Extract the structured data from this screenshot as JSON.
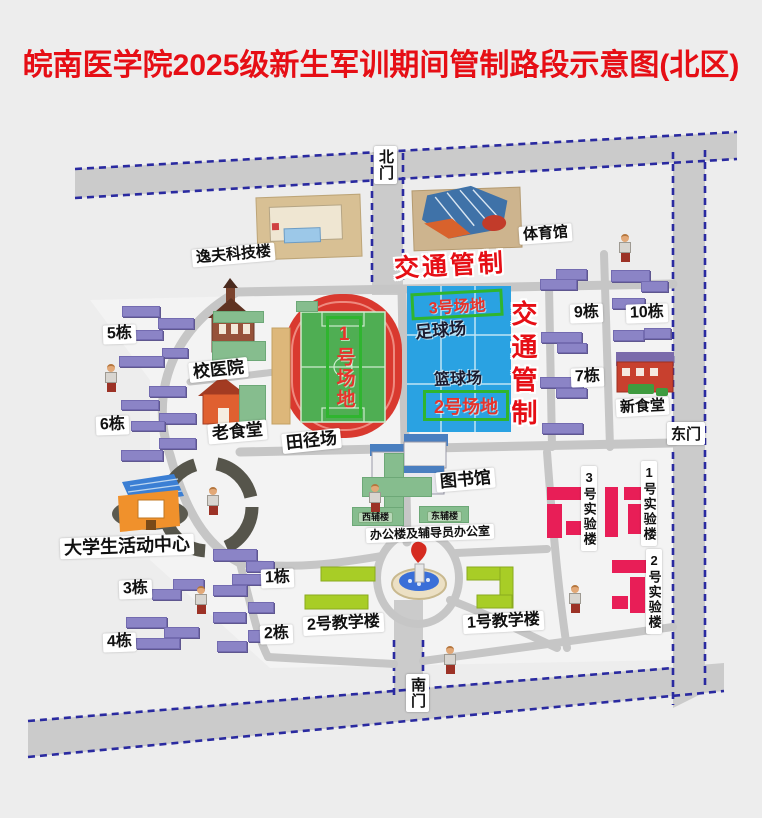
{
  "title": "皖南医学院2025级新生军训期间管制路段示意图(北区)",
  "traffic_control": {
    "horizontal": "交通管制",
    "vertical": "交通管制"
  },
  "gates": {
    "north": "北门",
    "east": "东门",
    "south": "南门"
  },
  "fields": {
    "field1": "1号场地",
    "field2": "2号场地",
    "field3": "3号场地",
    "football": "足球场",
    "basketball": "篮球场"
  },
  "labels": [
    {
      "name": "yifu-science-building",
      "text": "逸夫科技楼",
      "x": 192,
      "y": 246,
      "fs": 15,
      "rot": -5
    },
    {
      "name": "gymnasium",
      "text": "体育馆",
      "x": 519,
      "y": 225,
      "fs": 15,
      "rot": -4
    },
    {
      "name": "school-hospital",
      "text": "校医院",
      "x": 189,
      "y": 360,
      "fs": 17,
      "rot": -6
    },
    {
      "name": "old-canteen",
      "text": "老食堂",
      "x": 208,
      "y": 422,
      "fs": 17,
      "rot": -5
    },
    {
      "name": "athletic-track",
      "text": "田径场",
      "x": 282,
      "y": 431,
      "fs": 17,
      "rot": -6
    },
    {
      "name": "library",
      "text": "图书馆",
      "x": 436,
      "y": 470,
      "fs": 17,
      "rot": -5
    },
    {
      "name": "new-canteen",
      "text": "新食堂",
      "x": 616,
      "y": 398,
      "fs": 15,
      "rot": -3
    },
    {
      "name": "student-activity-center",
      "text": "大学生活动中心",
      "x": 60,
      "y": 536,
      "fs": 18,
      "rot": -2
    },
    {
      "name": "office-counselor-building",
      "text": "办公楼及辅导员办公室",
      "x": 366,
      "y": 526,
      "fs": 12,
      "rot": -2
    },
    {
      "name": "teaching-building-2",
      "text": "2号教学楼",
      "x": 303,
      "y": 615,
      "fs": 16,
      "rot": -3
    },
    {
      "name": "teaching-building-1",
      "text": "1号教学楼",
      "x": 463,
      "y": 613,
      "fs": 16,
      "rot": -3
    },
    {
      "name": "dorm-5",
      "text": "5栋",
      "x": 103,
      "y": 325,
      "fs": 16,
      "rot": -2
    },
    {
      "name": "dorm-6",
      "text": "6栋",
      "x": 96,
      "y": 416,
      "fs": 16,
      "rot": -2
    },
    {
      "name": "dorm-9",
      "text": "9栋",
      "x": 570,
      "y": 304,
      "fs": 16,
      "rot": -2
    },
    {
      "name": "dorm-10",
      "text": "10栋",
      "x": 626,
      "y": 304,
      "fs": 16,
      "rot": -2
    },
    {
      "name": "dorm-7",
      "text": "7栋",
      "x": 571,
      "y": 368,
      "fs": 16,
      "rot": -2
    },
    {
      "name": "dorm-3",
      "text": "3栋",
      "x": 119,
      "y": 580,
      "fs": 16,
      "rot": -2
    },
    {
      "name": "dorm-4",
      "text": "4栋",
      "x": 103,
      "y": 633,
      "fs": 16,
      "rot": -2
    },
    {
      "name": "dorm-1",
      "text": "1栋",
      "x": 261,
      "y": 569,
      "fs": 16,
      "rot": -2
    },
    {
      "name": "dorm-2",
      "text": "2栋",
      "x": 260,
      "y": 625,
      "fs": 16,
      "rot": -2
    },
    {
      "name": "west-aux-building",
      "text": "西辅楼",
      "x": 358,
      "y": 512,
      "fs": 9,
      "green": true
    },
    {
      "name": "east-aux-building",
      "text": "东辅楼",
      "x": 427,
      "y": 511,
      "fs": 9,
      "green": true
    },
    {
      "name": "lab-building-3",
      "text": "3号实验楼",
      "x": 581,
      "y": 466,
      "fs": 13,
      "v": true
    },
    {
      "name": "lab-building-1",
      "text": "1号实验楼",
      "x": 641,
      "y": 461,
      "fs": 13,
      "v": true
    },
    {
      "name": "lab-building-2",
      "text": "2号实验楼",
      "x": 646,
      "y": 549,
      "fs": 13,
      "v": true
    }
  ],
  "dorm_bars": [
    [
      122,
      306,
      38,
      11
    ],
    [
      158,
      318,
      36,
      11
    ],
    [
      135,
      330,
      28,
      10
    ],
    [
      162,
      348,
      26,
      10
    ],
    [
      119,
      356,
      45,
      11
    ],
    [
      149,
      386,
      37,
      11
    ],
    [
      121,
      400,
      38,
      10
    ],
    [
      159,
      413,
      37,
      11
    ],
    [
      131,
      421,
      34,
      10
    ],
    [
      159,
      438,
      37,
      11
    ],
    [
      121,
      450,
      42,
      11
    ],
    [
      556,
      269,
      31,
      11
    ],
    [
      540,
      279,
      37,
      11
    ],
    [
      541,
      332,
      41,
      11
    ],
    [
      557,
      343,
      30,
      10
    ],
    [
      540,
      377,
      43,
      11
    ],
    [
      556,
      388,
      31,
      10
    ],
    [
      542,
      423,
      41,
      11
    ],
    [
      611,
      270,
      39,
      12
    ],
    [
      641,
      281,
      27,
      11
    ],
    [
      612,
      298,
      33,
      11
    ],
    [
      613,
      330,
      31,
      11
    ],
    [
      644,
      328,
      27,
      11
    ],
    [
      213,
      549,
      44,
      12
    ],
    [
      246,
      561,
      28,
      11
    ],
    [
      232,
      574,
      40,
      11
    ],
    [
      173,
      579,
      31,
      11
    ],
    [
      152,
      589,
      29,
      11
    ],
    [
      213,
      585,
      34,
      11
    ],
    [
      248,
      602,
      26,
      11
    ],
    [
      213,
      612,
      33,
      11
    ],
    [
      126,
      617,
      41,
      11
    ],
    [
      164,
      627,
      35,
      11
    ],
    [
      248,
      630,
      26,
      12
    ],
    [
      136,
      638,
      44,
      11
    ],
    [
      217,
      641,
      30,
      11
    ]
  ],
  "green_patches": [
    [
      213,
      311,
      51,
      12
    ],
    [
      212,
      341,
      54,
      20
    ],
    [
      239,
      385,
      27,
      39
    ],
    [
      296,
      301,
      22,
      11
    ],
    [
      384,
      453,
      20,
      60
    ],
    [
      362,
      477,
      70,
      20
    ],
    [
      352,
      507,
      52,
      19
    ],
    [
      419,
      506,
      50,
      17
    ]
  ],
  "people": [
    [
      104,
      364
    ],
    [
      618,
      234
    ],
    [
      206,
      487
    ],
    [
      368,
      484
    ],
    [
      194,
      586
    ],
    [
      568,
      585
    ],
    [
      443,
      646
    ]
  ],
  "colors": {
    "title_red": "#e60e15",
    "road_gray": "#cbcbcb",
    "road_dash_blue": "#2a2aa0",
    "inner_road": "#c6c6c6",
    "dorm_purple": "#8b84c6",
    "court_blue": "#2aa2e2",
    "field_green": "#4fae53",
    "track_red": "#d9392f",
    "teaching_green": "#a8cd26",
    "lab_crimson": "#e81e57",
    "lawn_green": "#86bd8e",
    "control_red": "#e60e15",
    "field_box_border": "#2fb52f"
  }
}
